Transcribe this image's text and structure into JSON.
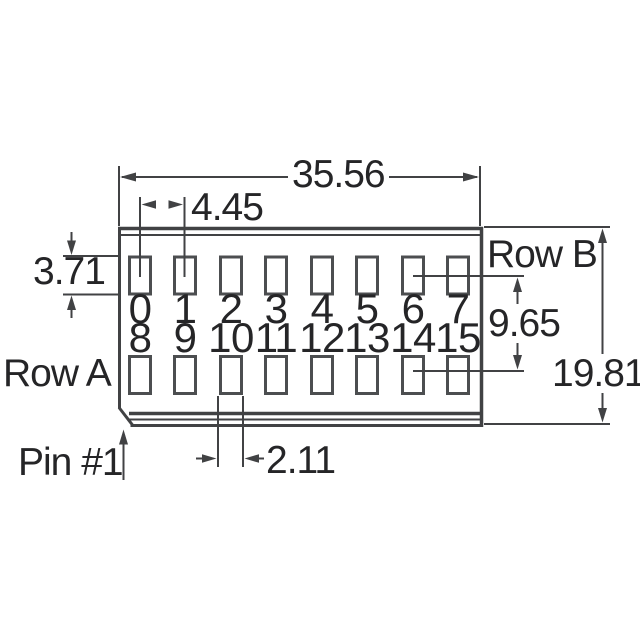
{
  "labels": {
    "row_a": "Row A",
    "row_b": "Row B",
    "pin1": "Pin #1"
  },
  "dimensions": {
    "overall_width": "35.56",
    "pin_pitch": "4.45",
    "pad_height": "3.71",
    "row_spacing": "9.65",
    "overall_height": "19.81",
    "pad_width": "2.11"
  },
  "pins": {
    "row_b": [
      "0",
      "1",
      "2",
      "3",
      "4",
      "5",
      "6",
      "7"
    ],
    "row_a": [
      "8",
      "9",
      "10",
      "11",
      "12",
      "13",
      "14",
      "15"
    ]
  },
  "icons": {
    "dimension_arrows": "arrowhead-icon"
  },
  "colors": {
    "line": "#414244",
    "pad_stroke": "#4c4e50",
    "text": "#252527",
    "background": "#ffffff"
  }
}
